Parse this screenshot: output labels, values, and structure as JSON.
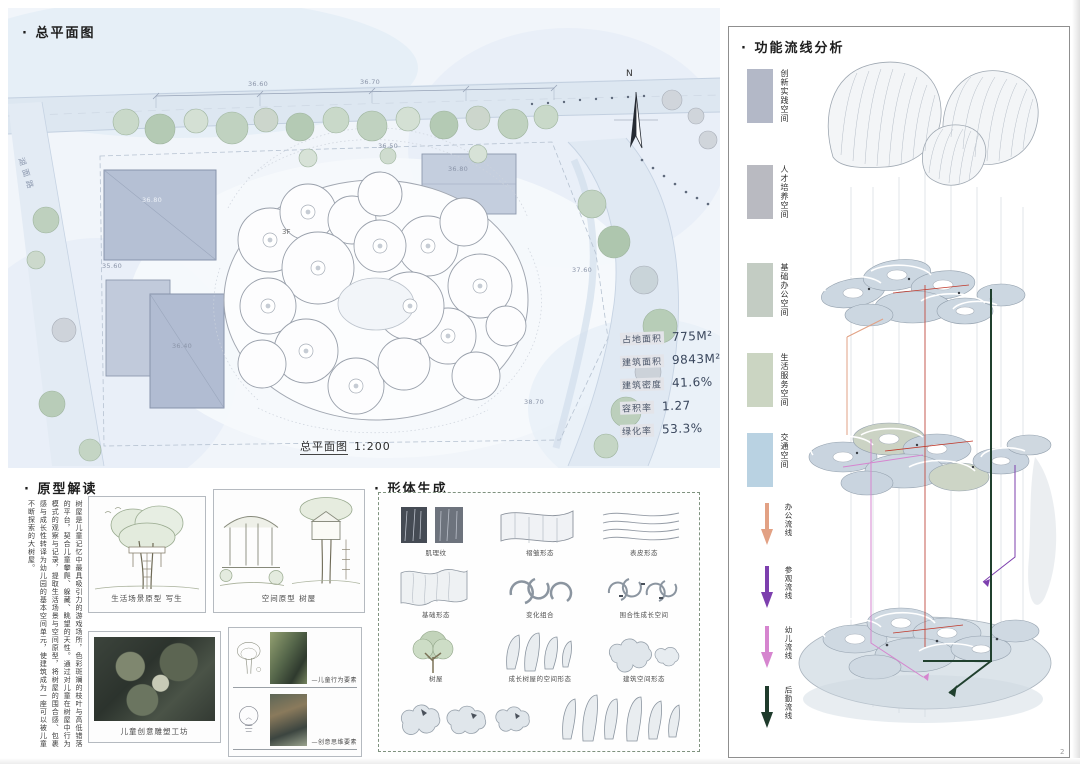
{
  "page": {
    "number": "2"
  },
  "site_plan": {
    "title": "· 总平面图",
    "caption_title": "总平面图",
    "caption_scale": "1:200",
    "road_label": "湖面路",
    "north_label": "N",
    "floor_label": "3F",
    "dimensions": [
      "36.60",
      "36.70",
      "36.50",
      "36.80",
      "35.60",
      "36.40",
      "36.80",
      "37.60",
      "38.70"
    ],
    "stats": [
      {
        "label": "占地面积",
        "value": "775M²"
      },
      {
        "label": "建筑面积",
        "value": "9843M²"
      },
      {
        "label": "建筑密度",
        "value": "41.6%"
      },
      {
        "label": "容积率",
        "value": "1.27"
      },
      {
        "label": "绿化率",
        "value": "53.3%"
      }
    ]
  },
  "prototype": {
    "title": "· 原型解读",
    "paragraph": "树屋是儿童记忆中最具吸引力的游戏场所，色彩斑斓的枝叶与高低错落的平台，契合儿童攀爬、躲藏、眺望的天性。通过对儿童在树屋中行为模式的观察与记录，提取生活场景与空间原型，将树屋的围合感、包裹感与成长性转译为幼儿园的基本空间单元，使建筑成为一座可以被儿童不断探索的大树屋。",
    "caption_life": "生活场景原型 写生",
    "caption_space": "空间原型 树屋",
    "caption_workshop": "儿童创意雕塑工坊",
    "elements": [
      {
        "label": "—儿童行为要素"
      },
      {
        "label": "—创意思维要素"
      }
    ]
  },
  "form_generation": {
    "title": "· 形体生成",
    "captions": [
      "肌理纹",
      "褶皱形态",
      "表皮形态",
      "基础形态",
      "变化组合",
      "围合性成长空间",
      "树屋",
      "成长树屋的空间形态",
      "建筑空间形态"
    ]
  },
  "analysis": {
    "title": "· 功能流线分析",
    "legend": [
      {
        "label": "创新实践空间",
        "color": "#b3b8c7"
      },
      {
        "label": "人才培养空间",
        "color": "#b9bac1"
      },
      {
        "label": "基础办公空间",
        "color": "#c3ccc3"
      },
      {
        "label": "生活服务空间",
        "color": "#cbd5c2"
      },
      {
        "label": "交通空间",
        "color": "#b9d2e2"
      }
    ],
    "flows": [
      {
        "label": "办公流线",
        "color": "#e2a184"
      },
      {
        "label": "参观流线",
        "color": "#7d3fae"
      },
      {
        "label": "幼儿流线",
        "color": "#d685cf"
      },
      {
        "label": "后勤流线",
        "color": "#1f3b2c"
      }
    ]
  }
}
